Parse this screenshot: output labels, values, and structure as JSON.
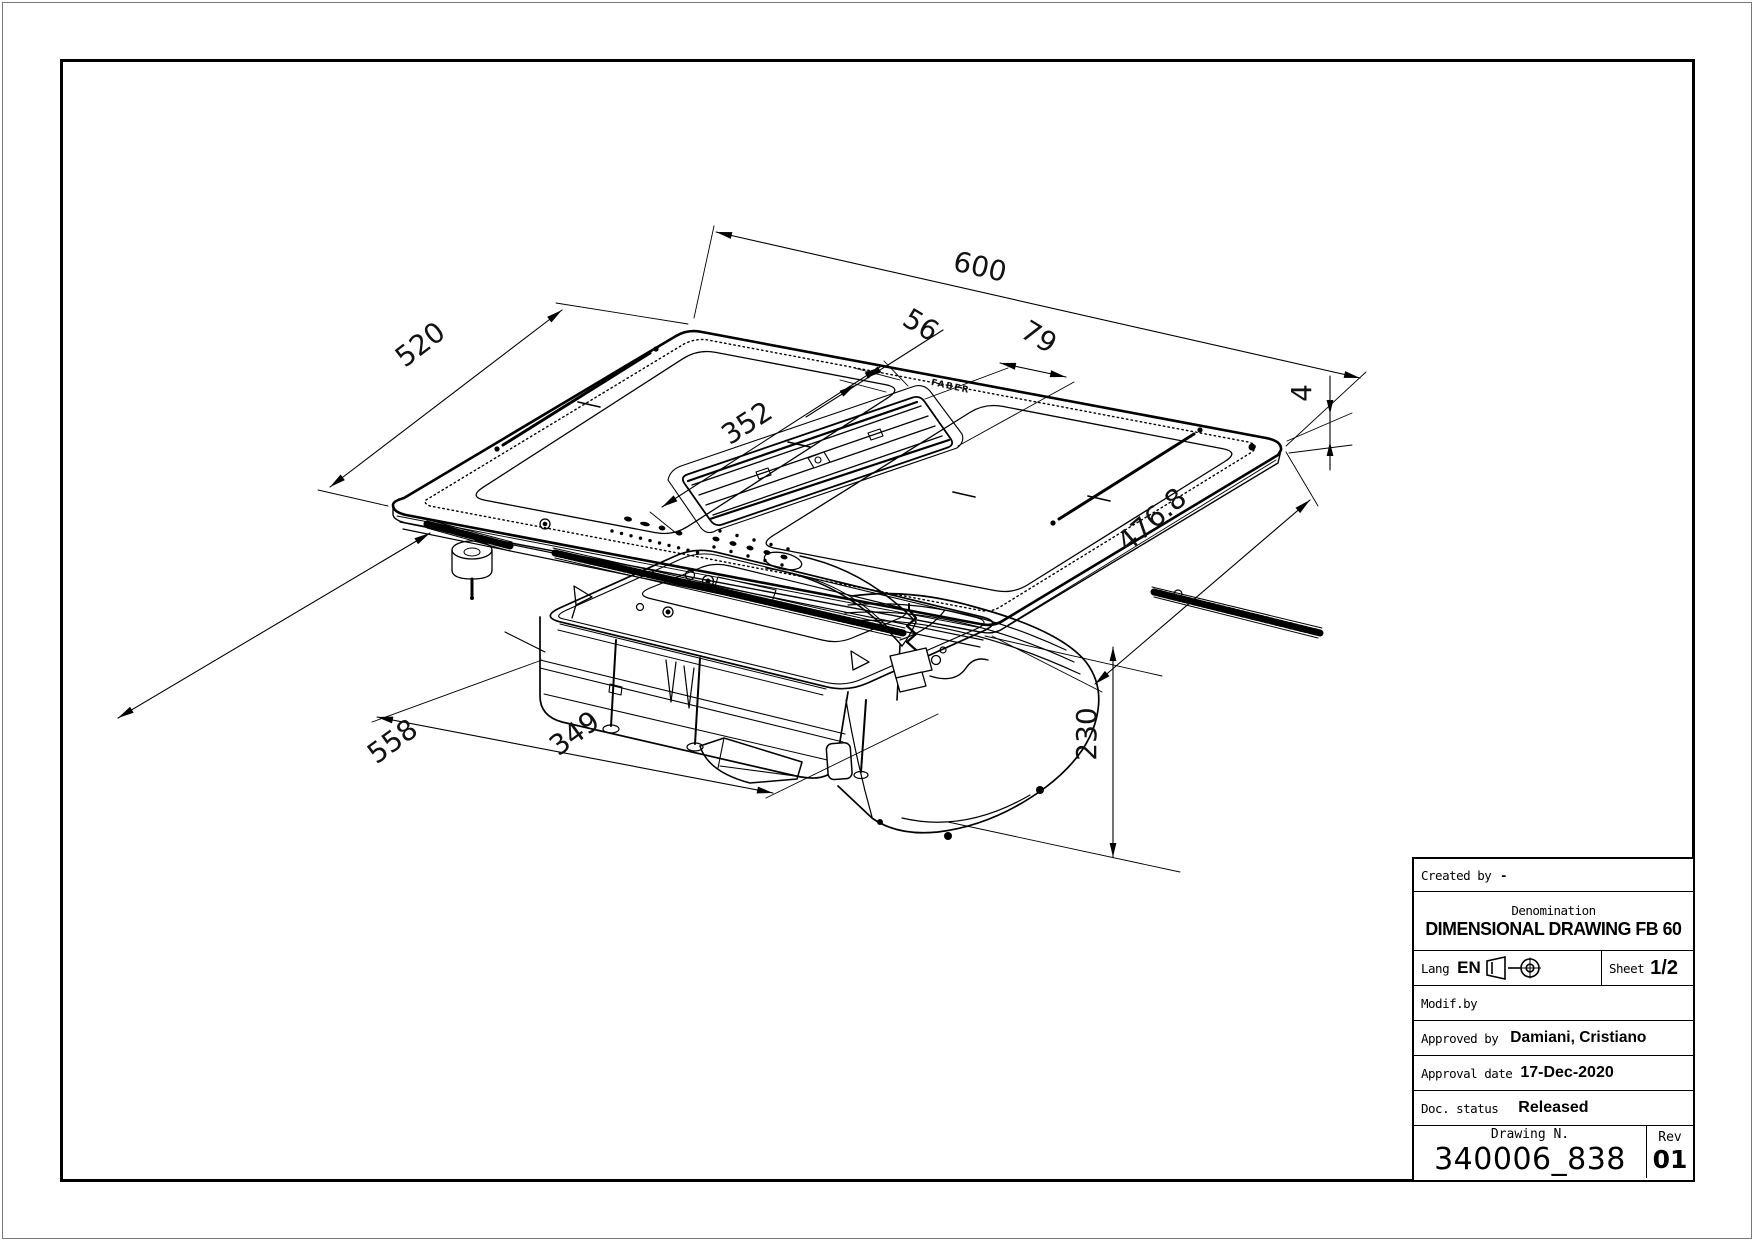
{
  "drawing": {
    "logo": "FABER",
    "dimensions": {
      "width": "600",
      "depth": "520",
      "grill_gap": "56",
      "grill_width": "79",
      "zone_length": "352",
      "glass_thickness": "4",
      "cutout_depth": "476.8",
      "overall_under_depth": "558",
      "box_length": "349",
      "under_height": "230"
    }
  },
  "title_block": {
    "created_by_label": "Created by",
    "created_by_value": "-",
    "denomination_label": "Denomination",
    "denomination_value": "DIMENSIONAL DRAWING FB 60",
    "lang_label": "Lang",
    "lang_value": "EN",
    "projection_icon": "first-angle-projection",
    "sheet_label": "Sheet",
    "sheet_value": "1/2",
    "modif_label": "Modif.by",
    "approved_label": "Approved by",
    "approved_value": "Damiani, Cristiano",
    "approval_date_label": "Approval date",
    "approval_date_value": "17-Dec-2020",
    "doc_status_label": "Doc. status",
    "doc_status_value": "Released",
    "drawing_n_label": "Drawing N.",
    "drawing_n_value": "340006_838",
    "rev_label": "Rev",
    "rev_value": "01"
  }
}
